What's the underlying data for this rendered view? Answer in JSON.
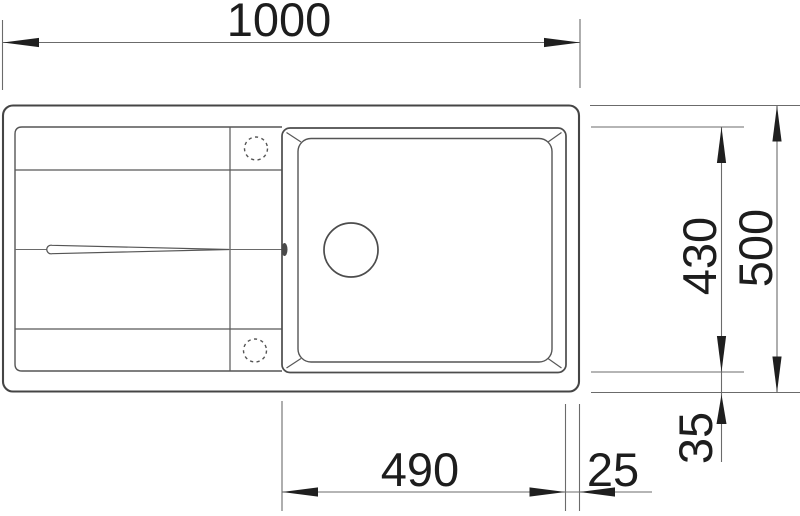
{
  "drawing": {
    "kind": "kitchen-sink-top-view-technical-drawing",
    "background_color": "#ffffff",
    "line_color": "#4c4c4c",
    "dimension_color": "#1d1d1d"
  },
  "dimensions": {
    "overall_width": "1000",
    "overall_depth": "500",
    "bowl_depth": "430",
    "bowl_bottom_offset": "35",
    "bowl_width": "490",
    "bowl_right_offset": "25"
  }
}
